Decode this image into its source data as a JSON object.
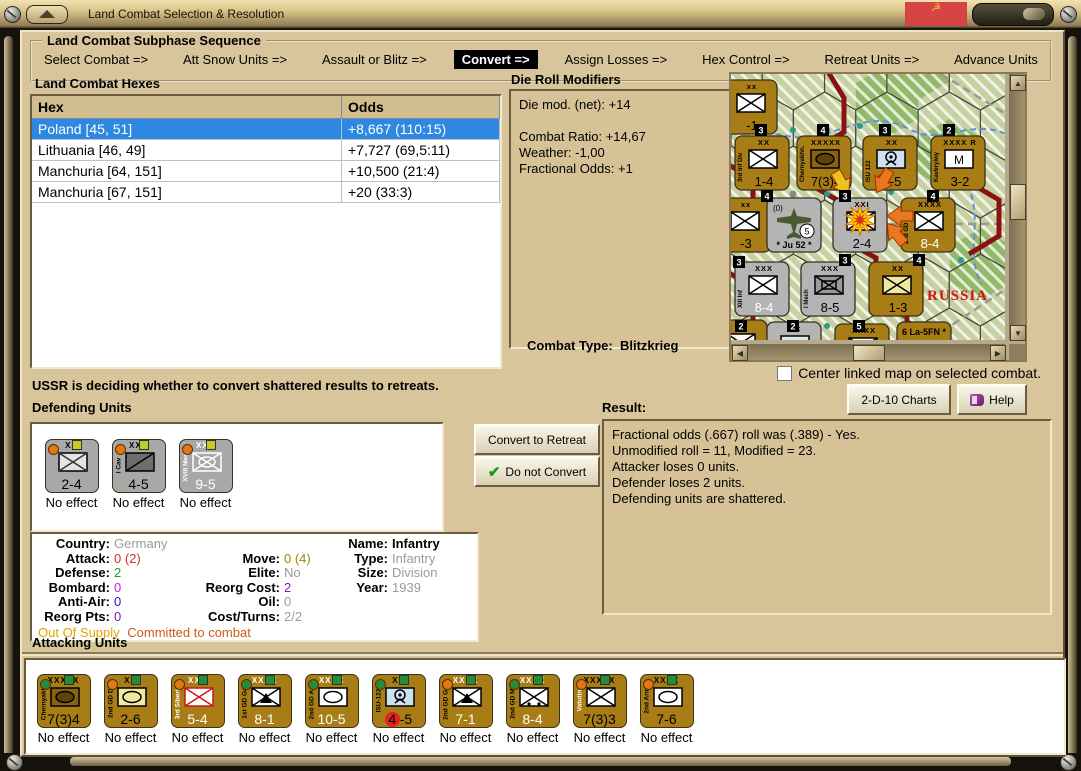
{
  "window": {
    "title": "Land Combat Selection & Resolution"
  },
  "colors": {
    "brown_counter": "#a87d15",
    "gray_counter": "#a8a8a8",
    "selected_row": "#2e87e0",
    "accent_black": "#000000",
    "dot_orange": "#e07818",
    "dot_green": "#2a8a3a",
    "dot_yellow": "#c8c82a"
  },
  "sequence": {
    "title": "Land Combat Subphase Sequence",
    "steps": [
      {
        "label": "Select Combat =>",
        "active": false
      },
      {
        "label": "Att Snow Units =>",
        "active": false
      },
      {
        "label": "Assault or Blitz =>",
        "active": false
      },
      {
        "label": "Convert =>",
        "active": true
      },
      {
        "label": "Assign Losses =>",
        "active": false
      },
      {
        "label": "Hex Control =>",
        "active": false
      },
      {
        "label": "Retreat Units =>",
        "active": false
      },
      {
        "label": "Advance Units",
        "active": false
      }
    ]
  },
  "hexes": {
    "title": "Land Combat Hexes",
    "columns": [
      "Hex",
      "Odds"
    ],
    "rows": [
      {
        "hex": "Poland [45, 51]",
        "odds": "+8,667 (110:15)",
        "selected": true
      },
      {
        "hex": "Lithuania [46, 49]",
        "odds": "+7,727 (69,5:11)",
        "selected": false
      },
      {
        "hex": "Manchuria [64, 151]",
        "odds": "+10,500 (21:4)",
        "selected": false
      },
      {
        "hex": "Manchuria [67, 151]",
        "odds": "+20 (33:3)",
        "selected": false
      }
    ]
  },
  "die_roll": {
    "title": "Die Roll Modifiers",
    "lines": [
      "Die mod. (net): +14",
      "",
      "Combat Ratio: +14,67",
      "Weather: -1,00",
      "Fractional Odds: +1"
    ]
  },
  "combat_type": {
    "label": "Combat Type:",
    "value": "Blitzkrieg"
  },
  "center_checkbox": {
    "label": "Center linked map on selected combat.",
    "checked": false
  },
  "buttons": {
    "charts": "2-D-10 Charts",
    "help": "Help",
    "convert": "Convert to Retreat",
    "do_not_convert": "Do not Convert"
  },
  "status_message": "USSR is deciding whether to convert shattered results to retreats.",
  "result": {
    "title": "Result:",
    "lines": [
      "Fractional odds (.667) roll was (.389)  - Yes.",
      "Unmodified roll = 11, Modified = 23.",
      "Attacker loses 0 units.",
      "Defender loses 2 units.",
      "Defending units are shattered."
    ]
  },
  "defending": {
    "title": "Defending Units",
    "units": [
      {
        "side": "",
        "size": "XX",
        "symbol": "inf_light",
        "strength": "2-4",
        "effect": "No effect",
        "color": "gray",
        "dot_left": "orange",
        "dot_top": "yellow",
        "strength_color": "#000",
        "size_color": "#000",
        "side_color": "#000"
      },
      {
        "side": "I Cav",
        "size": "XXX",
        "symbol": "cav",
        "strength": "4-5",
        "effect": "No effect",
        "color": "gray",
        "dot_left": "orange",
        "dot_top": "yellow",
        "strength_color": "#000",
        "size_color": "#000",
        "side_color": "#000"
      },
      {
        "side": "XVIII Mech",
        "size": "XXX",
        "symbol": "mech_white",
        "strength": "9-5",
        "effect": "No effect",
        "color": "gray",
        "dot_left": "orange",
        "dot_top": "yellow",
        "strength_color": "#fff",
        "size_color": "#fff",
        "side_color": "#fff"
      }
    ]
  },
  "unit_details": {
    "rows": [
      [
        {
          "label": "Country:",
          "value": "Germany",
          "color": "#9a9a9a"
        },
        null,
        {
          "label": "Name:",
          "value": "Infantry",
          "color": "#000000",
          "bold": true
        }
      ],
      [
        {
          "label": "Attack:",
          "value": "0 (2)",
          "color": "#d03020"
        },
        {
          "label": "Move:",
          "value": "0 (4)",
          "color": "#a08800"
        },
        {
          "label": "Type:",
          "value": "Infantry",
          "color": "#9a9a9a"
        }
      ],
      [
        {
          "label": "Defense:",
          "value": "2",
          "color": "#209a20"
        },
        {
          "label": "Elite:",
          "value": "No",
          "color": "#9a9a9a"
        },
        {
          "label": "Size:",
          "value": "Division",
          "color": "#9a9a9a"
        }
      ],
      [
        {
          "label": "Bombard:",
          "value": "0",
          "color": "#cc20cc"
        },
        {
          "label": "Reorg Cost:",
          "value": "2",
          "color": "#8020a0"
        },
        {
          "label": "Year:",
          "value": "1939",
          "color": "#9a9a9a"
        }
      ],
      [
        {
          "label": "Anti-Air:",
          "value": "0",
          "color": "#2020cc"
        },
        {
          "label": "Oil:",
          "value": "0",
          "color": "#9a9a9a"
        },
        null
      ],
      [
        {
          "label": "Reorg Pts:",
          "value": "0",
          "color": "#8020a0"
        },
        {
          "label": "Cost/Turns:",
          "value": "2/2",
          "color": "#9a9a9a"
        },
        null
      ]
    ],
    "supply": "Out Of Supply",
    "committed": "Committed to combat",
    "supply_color": "#e2a400",
    "committed_color": "#d05a14"
  },
  "attacking": {
    "title": "Attacking Units",
    "units": [
      {
        "side": "Chernyakho.",
        "size": "XXXXX",
        "symbol": "hq",
        "strength": "7(3)4",
        "effect": "No effect",
        "color": "brown",
        "dot_left": "green",
        "dot_top": "green",
        "strength_color": "#000",
        "size_color": "#000",
        "side_color": "#000"
      },
      {
        "side": "2nd GD Div",
        "size": "XX",
        "symbol": "arm_yellow",
        "strength": "2-6",
        "effect": "No effect",
        "color": "brown",
        "dot_left": "orange",
        "dot_top": "green",
        "strength_color": "#000",
        "size_color": "#000",
        "side_color": "#000"
      },
      {
        "side": "3rd Siberian",
        "size": "XXX",
        "symbol": "inf_red",
        "strength": "5-4",
        "effect": "No effect",
        "color": "brown",
        "dot_left": "orange",
        "dot_top": "green",
        "strength_color": "#fff",
        "size_color": "#fff",
        "side_color": "#fff"
      },
      {
        "side": "1st GD Garr",
        "size": "XXXX",
        "symbol": "garrison",
        "strength": "8-1",
        "effect": "No effect",
        "color": "brown",
        "dot_left": "green",
        "dot_top": "green",
        "strength_color": "#fff",
        "size_color": "#fff",
        "side_color": "#000"
      },
      {
        "side": "2nd GD Arm",
        "size": "XXXX",
        "symbol": "armor",
        "strength": "10-5",
        "effect": "No effect",
        "color": "brown",
        "dot_left": "green",
        "dot_top": "green",
        "strength_color": "#fff",
        "size_color": "#fff",
        "side_color": "#000"
      },
      {
        "side": "ISU-122",
        "size": "XX",
        "symbol": "sp_art",
        "strength": "4-5",
        "red_circle": true,
        "effect": "No effect",
        "color": "brown",
        "dot_left": "green",
        "dot_top": "green",
        "strength_color": "#000",
        "size_color": "#000",
        "side_color": "#000"
      },
      {
        "side": "2nd GD Garr",
        "size": "XXXX",
        "symbol": "garrison",
        "strength": "7-1",
        "effect": "No effect",
        "color": "brown",
        "dot_left": "orange",
        "dot_top": "green",
        "strength_color": "#fff",
        "size_color": "#fff",
        "side_color": "#000"
      },
      {
        "side": "2nd GD Mot",
        "size": "XXXX",
        "symbol": "motorized",
        "strength": "8-4",
        "effect": "No effect",
        "color": "brown",
        "dot_left": "green",
        "dot_top": "green",
        "strength_color": "#fff",
        "size_color": "#fff",
        "side_color": "#000"
      },
      {
        "side": "Vatutin",
        "size": "XXXXX",
        "symbol": "inf",
        "strength": "7(3)3",
        "effect": "No effect",
        "color": "brown",
        "dot_left": "orange",
        "dot_top": "green",
        "strength_color": "#000",
        "size_color": "#000",
        "side_color": "#fff"
      },
      {
        "side": "2nd Arm",
        "size": "XXXX",
        "symbol": "armor",
        "strength": "7-6",
        "effect": "No effect",
        "color": "brown",
        "dot_left": "orange",
        "dot_top": "green",
        "strength_color": "#000",
        "size_color": "#000",
        "side_color": "#000"
      }
    ]
  },
  "map": {
    "region_label": "RUSSIA",
    "hex_numbers": [
      [
        24,
        50,
        "3"
      ],
      [
        86,
        50,
        "4"
      ],
      [
        148,
        50,
        "3"
      ],
      [
        212,
        50,
        "2"
      ],
      [
        30,
        116,
        "4"
      ],
      [
        108,
        116,
        "3"
      ],
      [
        196,
        116,
        "4"
      ],
      [
        108,
        180,
        "3"
      ],
      [
        182,
        180,
        "4"
      ],
      [
        2,
        182,
        "3"
      ],
      [
        4,
        246,
        "2"
      ],
      [
        56,
        246,
        "2"
      ],
      [
        122,
        246,
        "5"
      ]
    ],
    "counters": [
      {
        "x": -8,
        "y": 6,
        "color": "brown",
        "size": "xx",
        "symbol": "inf",
        "strength": "-1",
        "side": "",
        "strength_color": "#000"
      },
      {
        "x": 4,
        "y": 62,
        "color": "brown",
        "size": "XX",
        "symbol": "inf",
        "strength": "1-4",
        "side": "3rd Inf Div",
        "strength_color": "#000"
      },
      {
        "x": 66,
        "y": 62,
        "color": "brown",
        "size": "XXXXX",
        "symbol": "hq",
        "strength": "7(3)4",
        "side": "Chernyakhn.",
        "strength_color": "#000"
      },
      {
        "x": 132,
        "y": 62,
        "color": "brown",
        "size": "XX",
        "symbol": "sp_art",
        "strength": "4-5",
        "side": "ISU 122",
        "red_circle": true,
        "strength_color": "#000"
      },
      {
        "x": 200,
        "y": 62,
        "color": "brown",
        "size": "XXXX R",
        "symbol": "m_box",
        "strength": "3-2",
        "side": "Kavbrylwy",
        "strength_color": "#000"
      },
      {
        "x": -14,
        "y": 124,
        "color": "brown",
        "size": "xx",
        "symbol": "inf",
        "strength": "-3",
        "side": "",
        "strength_color": "#000"
      },
      {
        "x": 36,
        "y": 124,
        "color": "gray",
        "air": true,
        "extra": "(0)",
        "badge": "5",
        "strength": "Ju 52",
        "strength_color": "#000"
      },
      {
        "x": 102,
        "y": 124,
        "color": "gray",
        "size": "XXI",
        "symbol": "inf",
        "strength": "2-4",
        "side": "",
        "explosion": true,
        "strength_color": "#000"
      },
      {
        "x": 170,
        "y": 124,
        "color": "brown",
        "size": "XXXX",
        "symbol": "inf",
        "strength": "8-4",
        "side": "2nd GD Mot",
        "strength_color": "#fff"
      },
      {
        "x": 4,
        "y": 188,
        "color": "gray",
        "size": "XXX",
        "symbol": "inf",
        "strength": "8-4",
        "side": "XIII Inf",
        "strength_color": "#fff"
      },
      {
        "x": 70,
        "y": 188,
        "color": "gray",
        "size": "XXX",
        "symbol": "mech",
        "strength": "8-5",
        "side": "I Mech",
        "strength_color": "#000"
      },
      {
        "x": 138,
        "y": 188,
        "color": "brown",
        "size": "XX",
        "symbol": "inf_yellow",
        "strength": "1-3",
        "side": "",
        "strength_color": "#000"
      },
      {
        "x": -18,
        "y": 246,
        "color": "brown",
        "size": "",
        "symbol": "inf",
        "strength": "1",
        "side": "",
        "strength_color": "#000"
      },
      {
        "x": 36,
        "y": 248,
        "color": "gray",
        "size": "xx",
        "symbol": "depot",
        "strength": "",
        "side": "",
        "strength_color": "#000"
      },
      {
        "x": 104,
        "y": 250,
        "color": "brown",
        "size": "XXXX",
        "symbol": "inf",
        "strength": "",
        "side": "",
        "strength_color": "#000"
      },
      {
        "x": 166,
        "y": 248,
        "color": "brown",
        "air2": true,
        "strength": "6 La-5FN *",
        "strength_color": "#000"
      }
    ]
  }
}
